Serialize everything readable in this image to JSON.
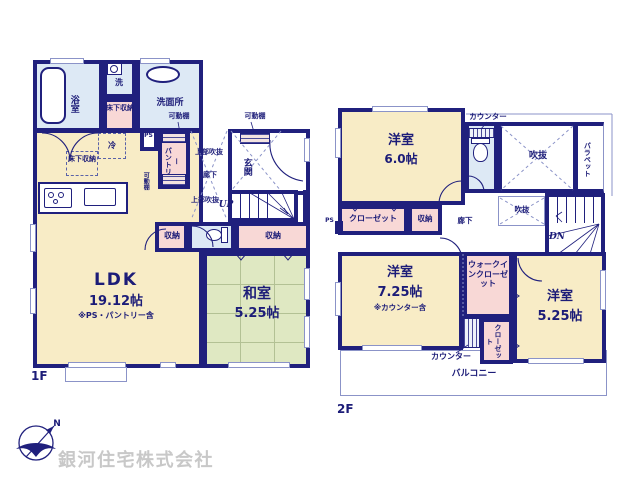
{
  "colors": {
    "wall": "#20207d",
    "text": "#1c1c78",
    "room_cream": "#f8ecc6",
    "room_pink": "#f8d8d6",
    "room_blue": "#dde9f5",
    "room_tatami_green": "#dfe8c2",
    "thin_line": "#8b93c8",
    "company_gray": "#c8c8c8"
  },
  "f1": {
    "floor_label": "1F",
    "bath": "浴室",
    "washer": "洗",
    "underfloor_a": "床下収納",
    "washroom": "洗面所",
    "shelf_a": "可動棚",
    "shelf_b": "可動棚",
    "shelf_side": "可動棚",
    "ps": "PS",
    "pantry": "パントリー",
    "fridge": "冷",
    "underfloor_b": "床下収納",
    "upper_void_a": "上部吹抜",
    "hall": "廊下",
    "genkan": "玄関",
    "upper_void_b": "上部吹抜",
    "up": "UP",
    "storage_a": "収納",
    "storage_b": "収納",
    "ldk_name": "LDK",
    "ldk_size": "19.12帖",
    "ldk_note": "※PS・パントリー含",
    "washitsu_name": "和室",
    "washitsu_size": "5.25帖"
  },
  "f2": {
    "floor_label": "2F",
    "bedroom1_name": "洋室",
    "bedroom1_size": "6.0帖",
    "counter_a": "カウンター",
    "void_a": "吹抜",
    "parapet": "パラペット",
    "closet_a": "クローゼット",
    "storage": "収納",
    "hall": "廊下",
    "void_b": "吹抜",
    "dn": "DN",
    "ps": "PS",
    "bedroom2_name": "洋室",
    "bedroom2_size": "7.25帖",
    "bedroom2_note": "※カウンター含",
    "wic": "ウォークインクローゼット",
    "counter_b": "カウンター",
    "closet_b": "クローゼット",
    "bedroom3_name": "洋室",
    "bedroom3_size": "5.25帖",
    "balcony": "バルコニー"
  },
  "footer": {
    "company": "銀河住宅株式会社",
    "compass": "N"
  }
}
